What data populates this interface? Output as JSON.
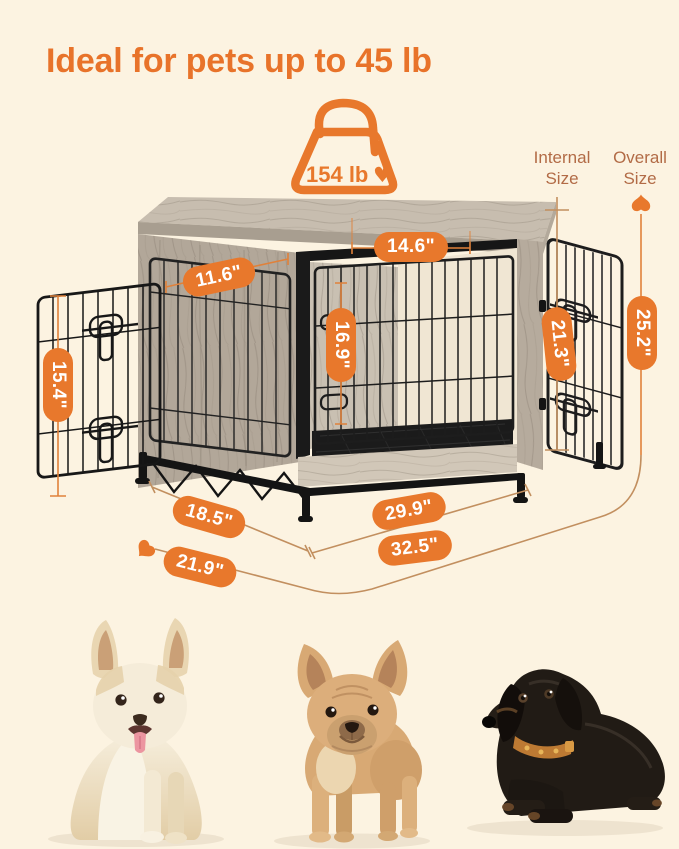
{
  "palette": {
    "background": "#fcf3e1",
    "accent_orange": "#e8782c",
    "title_orange": "#e8732a",
    "label_brown": "#b26b46",
    "line_tan": "#c28f5f",
    "wire_black": "#1d1d1d",
    "wood_greige": "#bdb3a6"
  },
  "header": {
    "title": "Ideal for pets up to 45 lb"
  },
  "weight_badge": {
    "capacity": "154 lb",
    "heart_icon": "♥",
    "icon": "weight-bag-icon"
  },
  "legend": {
    "internal_label": "Internal Size",
    "overall_label": "Overall Size"
  },
  "measurements": {
    "front_opening_width": "14.6\"",
    "side_door_width": "11.6\"",
    "interior_height": "16.9\"",
    "door_opening_height": "21.3\"",
    "overall_height": "25.2\"",
    "side_door_height": "15.4\"",
    "base_depth": "18.5\"",
    "base_width": "29.9\"",
    "overall_width": "32.5\"",
    "overall_depth": "21.9\""
  },
  "dogs": [
    {
      "id": "cream-corgi"
    },
    {
      "id": "fawn-french-bulldog"
    },
    {
      "id": "black-dachshund"
    }
  ]
}
